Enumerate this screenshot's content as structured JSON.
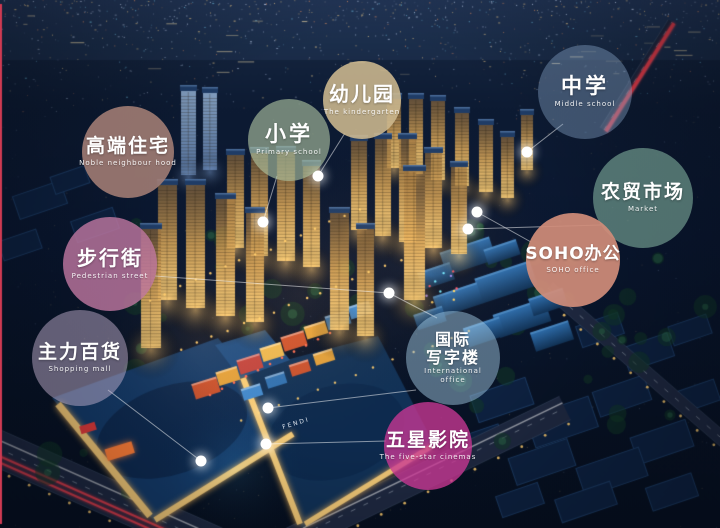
{
  "scene_description": "aerial night rendering of a mixed-use development with labeled facility bubbles",
  "colors": {
    "marker_dot": "#ffffff",
    "connector_line": "rgba(255,255,255,0.5)",
    "left_edge_line": "#ce3a52",
    "tower_light": "#f5c878",
    "mall_roof": "#143a68",
    "night_sky": "#0d1b33"
  },
  "signs": {
    "mall_brand": "FENDI"
  },
  "labels": [
    {
      "id": "noble-residence",
      "zh": "高端住宅",
      "en": "Noble neighbour hood",
      "cx": 128,
      "cy": 152,
      "r": 46,
      "fill": "rgba(164,126,117,0.88)"
    },
    {
      "id": "primary-school",
      "zh": "小学",
      "en": "Primary school",
      "cx": 289,
      "cy": 140,
      "r": 41,
      "fill": "rgba(178,198,163,0.62)"
    },
    {
      "id": "kindergarten",
      "zh": "幼儿园",
      "en": "The kindergarten",
      "cx": 362,
      "cy": 100,
      "r": 39,
      "fill": "rgba(206,185,143,0.88)"
    },
    {
      "id": "middle-school",
      "zh": "中学",
      "en": "Middle school",
      "cx": 585,
      "cy": 92,
      "r": 47,
      "fill": "rgba(140,170,205,0.40)"
    },
    {
      "id": "farmers-market",
      "zh": "农贸市场",
      "en": "Market",
      "cx": 643,
      "cy": 198,
      "r": 50,
      "fill": "rgba(152,206,180,0.50)"
    },
    {
      "id": "pedestrian-street",
      "zh": "步行街",
      "en": "Pedestrian street",
      "cx": 110,
      "cy": 264,
      "r": 47,
      "fill": "rgba(193,120,161,0.80)"
    },
    {
      "id": "soho-office",
      "zh": "SOHO办公",
      "en": "SOHO office",
      "cx": 573,
      "cy": 260,
      "r": 47,
      "fill": "rgba(209,141,121,0.92)"
    },
    {
      "id": "department-store",
      "zh": "主力百货",
      "en": "Shopping mall",
      "cx": 80,
      "cy": 358,
      "r": 48,
      "fill": "rgba(198,180,210,0.48)"
    },
    {
      "id": "international-office",
      "zh": "国际写字楼",
      "zh_lines": [
        "国际",
        "写字楼"
      ],
      "en": "International office",
      "en_lines": [
        "International",
        "office"
      ],
      "cx": 453,
      "cy": 358,
      "r": 47,
      "fill": "rgba(165,205,230,0.48)"
    },
    {
      "id": "five-star-cinema",
      "zh": "五星影院",
      "en": "The five-star cinemas",
      "cx": 428,
      "cy": 446,
      "r": 44,
      "fill": "rgba(201,55,148,0.78)"
    }
  ],
  "markers": [
    {
      "id": "m-kindergarten-site",
      "x": 318,
      "y": 176
    },
    {
      "id": "m-primary-site",
      "x": 263,
      "y": 222
    },
    {
      "id": "m-middle-site",
      "x": 527,
      "y": 152
    },
    {
      "id": "m-soho-site",
      "x": 477,
      "y": 212
    },
    {
      "id": "m-market-site",
      "x": 468,
      "y": 229
    },
    {
      "id": "m-intl-office-site",
      "x": 389,
      "y": 293
    },
    {
      "id": "m-mall-site",
      "x": 268,
      "y": 408
    },
    {
      "id": "m-cinema-site",
      "x": 266,
      "y": 444
    },
    {
      "id": "m-store-site",
      "x": 201,
      "y": 461
    }
  ],
  "connectors": [
    {
      "from": "kindergarten",
      "x1": 345,
      "y1": 133,
      "x2": 318,
      "y2": 176
    },
    {
      "from": "primary-school",
      "x1": 277,
      "y1": 176,
      "x2": 263,
      "y2": 222
    },
    {
      "from": "middle-school",
      "x1": 563,
      "y1": 124,
      "x2": 527,
      "y2": 152
    },
    {
      "from": "farmers-market",
      "x1": 601,
      "y1": 225,
      "x2": 468,
      "y2": 229
    },
    {
      "from": "soho-office",
      "x1": 531,
      "y1": 242,
      "x2": 477,
      "y2": 212
    },
    {
      "from": "pedestrian-street",
      "x1": 155,
      "y1": 276,
      "x2": 389,
      "y2": 293
    },
    {
      "from": "international-office",
      "x1": 437,
      "y1": 318,
      "x2": 389,
      "y2": 293
    },
    {
      "from": "international-office",
      "x1": 416,
      "y1": 390,
      "x2": 268,
      "y2": 408
    },
    {
      "from": "department-store",
      "x1": 108,
      "y1": 390,
      "x2": 201,
      "y2": 461
    },
    {
      "from": "five-star-cinema",
      "x1": 386,
      "y1": 441,
      "x2": 266,
      "y2": 444
    }
  ]
}
